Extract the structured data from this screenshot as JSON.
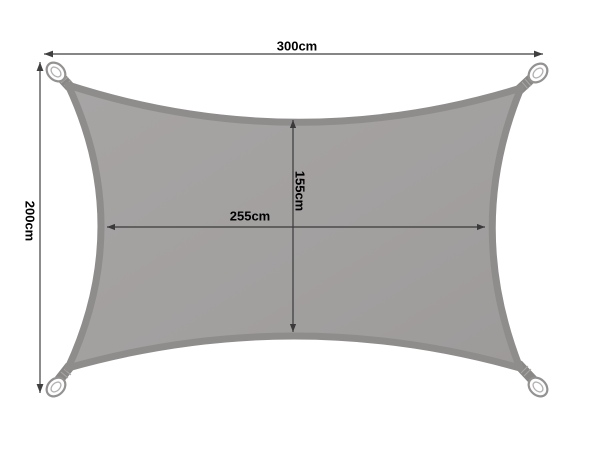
{
  "diagram": {
    "title": "Rectangular shade sail dimension diagram",
    "labels": {
      "outer_width": "300cm",
      "outer_height": "200cm",
      "inner_width": "255cm",
      "inner_height": "155cm"
    },
    "colors": {
      "background": "#ffffff",
      "sail_fill": "#a29f9f",
      "sail_fill_light": "#a7a4a4",
      "sail_edge_band": "#8f8c8c",
      "strap": "#8a8787",
      "strap_stitch": "#aaa7a7",
      "ring_body": "#fdfdfd",
      "ring_stroke": "#949191",
      "dimension_line": "#3f3f3f",
      "label_text": "#000000"
    }
  }
}
